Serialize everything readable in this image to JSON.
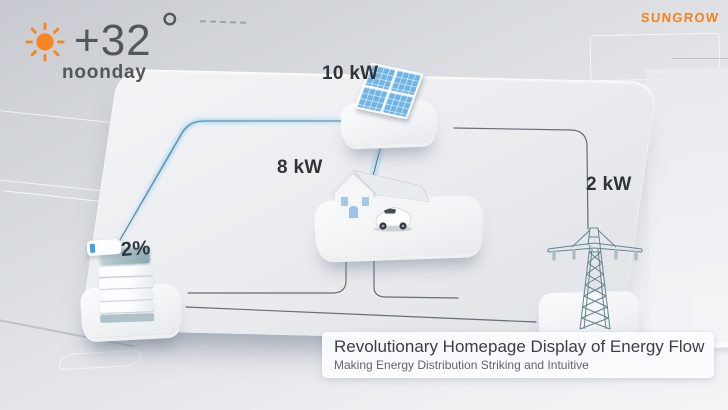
{
  "brand": {
    "name": "SUNGROW",
    "color": "#f5821f"
  },
  "weather": {
    "temperature": "+32",
    "degree": "°",
    "label": "noonday",
    "icon": "sun-icon",
    "icon_color": "#f6861f"
  },
  "nodes": {
    "solar": {
      "name": "solar-panel",
      "value": "10 kW"
    },
    "home": {
      "name": "house",
      "value": "8 kW"
    },
    "grid": {
      "name": "power-pylon",
      "value": "2 kW"
    },
    "battery": {
      "name": "battery-tower",
      "value": "2%"
    }
  },
  "flows": [
    {
      "from": "solar",
      "to": "battery",
      "state": "active-glow"
    },
    {
      "from": "solar",
      "to": "home",
      "state": "active-glow"
    },
    {
      "from": "solar",
      "to": "grid",
      "state": "idle"
    },
    {
      "from": "home",
      "to": "battery",
      "state": "idle"
    },
    {
      "from": "home",
      "to": "grid",
      "state": "idle"
    },
    {
      "from": "battery",
      "to": "grid",
      "state": "idle"
    }
  ],
  "banner": {
    "title": "Revolutionary Homepage Display of Energy Flow",
    "subtitle": "Making Energy Distribution Striking and Intuitive"
  },
  "colors": {
    "accent_orange": "#f5821f",
    "solar_blue": "#6fb4e4",
    "flow_glow": "#a9d8ef",
    "wire_dark": "#474e57",
    "text_dark": "#2f343a",
    "text_gray": "#53575c"
  }
}
